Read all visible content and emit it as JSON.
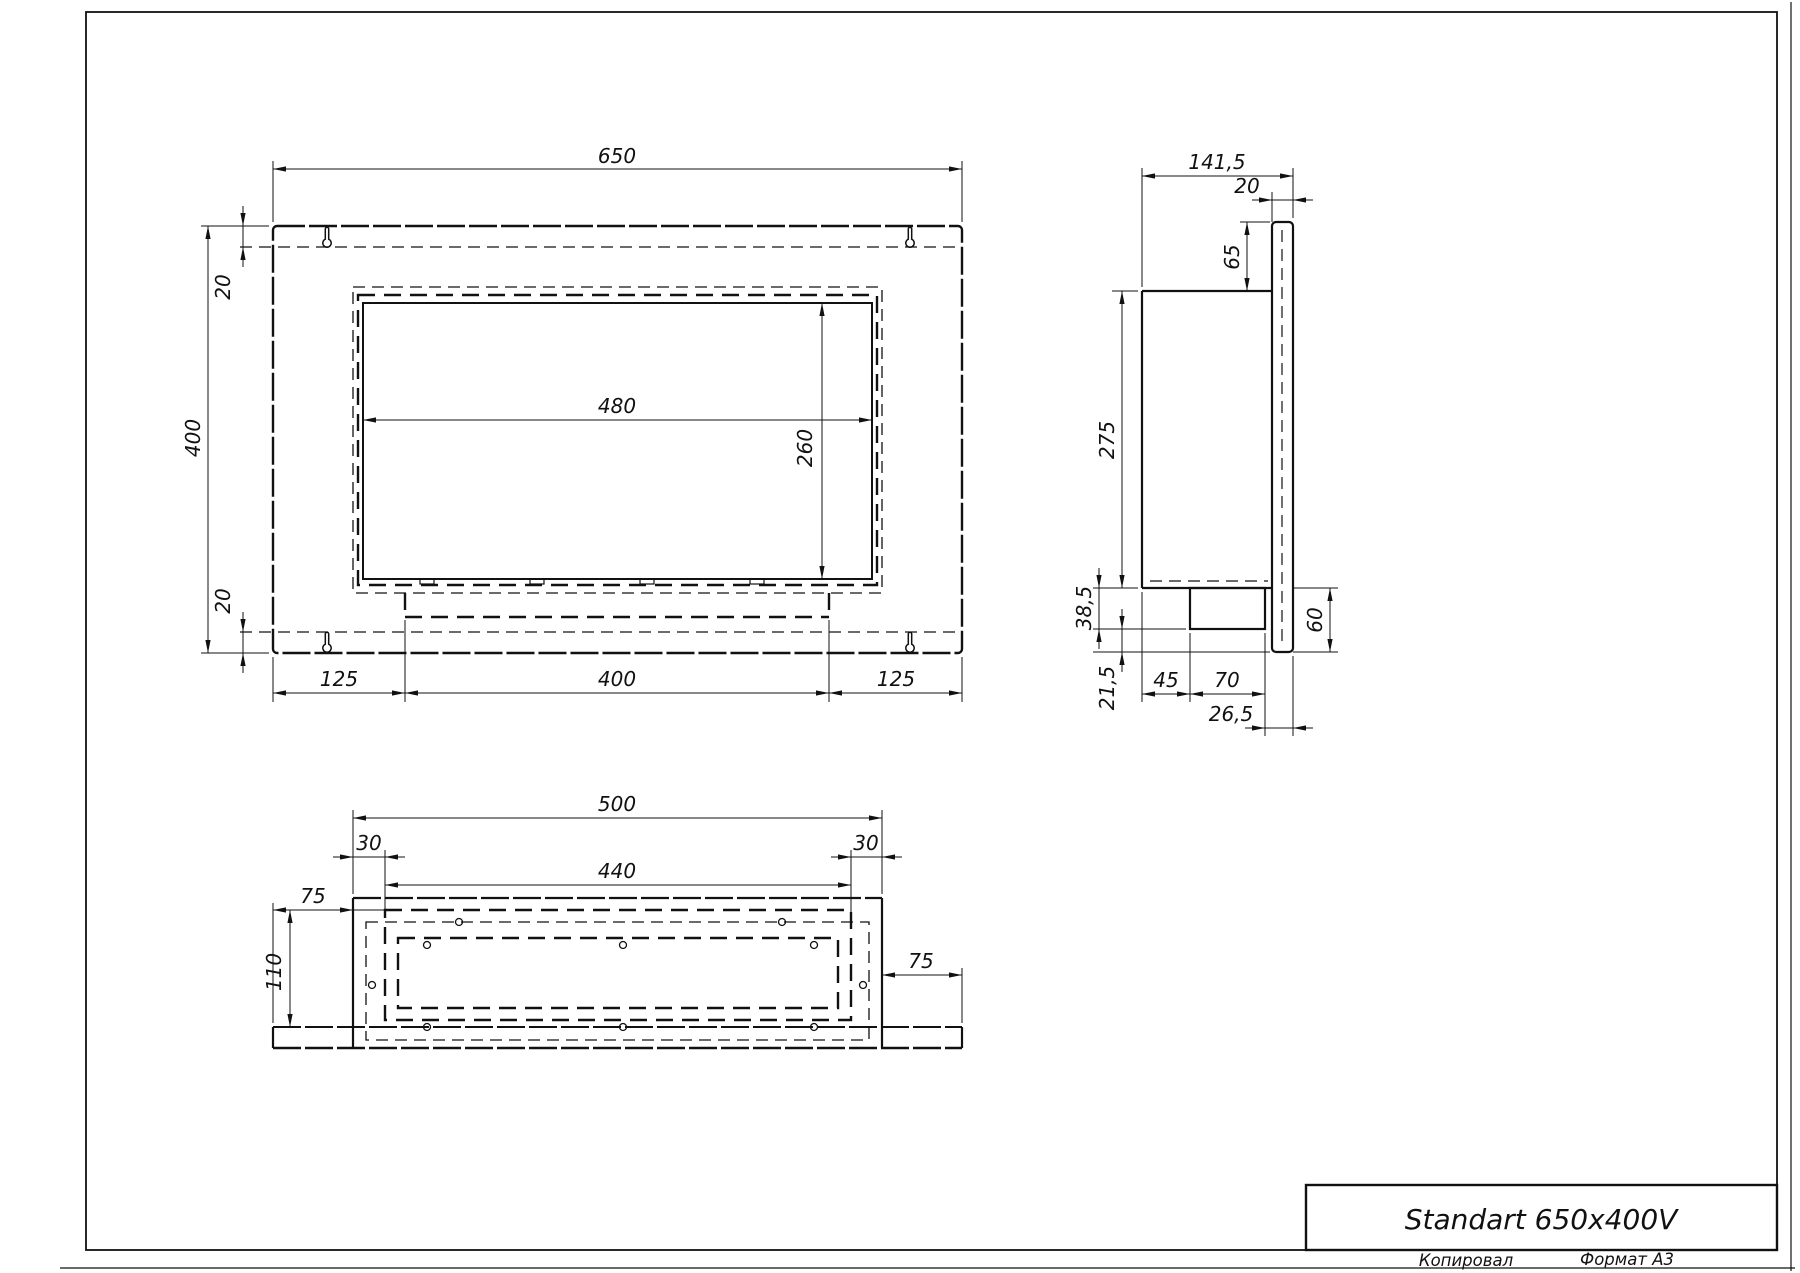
{
  "sheet": {
    "title": "Standart 650x400V",
    "footer_left": "Копировал",
    "footer_right": "Формат А3",
    "format": "A3"
  },
  "canvas": {
    "w": 1800,
    "h": 1273
  },
  "colors": {
    "line": "#111111",
    "background": "#ffffff"
  },
  "views": {
    "front_view_dimensions": [
      "650",
      "400",
      "20",
      "20",
      "480",
      "260",
      "125",
      "400",
      "125"
    ],
    "side_view_dimensions": [
      "141,5",
      "20",
      "65",
      "275",
      "38,5",
      "21,5",
      "45",
      "70",
      "26,5",
      "60"
    ],
    "bottom_view_dimensions": [
      "500",
      "30",
      "440",
      "30",
      "75",
      "110",
      "75"
    ]
  },
  "geometry": {
    "primitives": [
      {
        "k": "rect",
        "n": "sheet-frame",
        "x": 86,
        "y": 12,
        "w": 1691,
        "h": 1238,
        "lw": 1.8
      },
      {
        "k": "line",
        "n": "sheet-edge-right",
        "x1": 1791,
        "y1": 2,
        "x2": 1791,
        "y2": 1271,
        "lw": 1.2
      },
      {
        "k": "line",
        "n": "sheet-edge-bottom",
        "x1": 60,
        "y1": 1268,
        "x2": 1795,
        "y2": 1268,
        "lw": 1.2
      },
      {
        "k": "rect",
        "n": "title-block",
        "x": 1306,
        "y": 1185,
        "w": 471,
        "h": 65,
        "lw": 2.4
      },
      {
        "k": "text",
        "n": "title-block-title",
        "ref": "sheet.title",
        "x": 1541,
        "y": 1229,
        "fs": 28
      },
      {
        "k": "text",
        "n": "footer-copied-label",
        "ref": "sheet.footer_left",
        "x": 1466,
        "y": 1266,
        "fs": 16.5
      },
      {
        "k": "text",
        "n": "footer-format-label",
        "ref": "sheet.footer_right",
        "x": 1627,
        "y": 1265,
        "fs": 16.5
      },
      {
        "k": "rect",
        "n": "front-outer-panel",
        "x": 273,
        "y": 226,
        "w": 689,
        "h": 427,
        "lw": 2.4,
        "dash": "s",
        "rx": 4
      },
      {
        "k": "line",
        "n": "front-hidden-top-fold",
        "x1": 240,
        "y1": 247,
        "x2": 959,
        "y2": 247,
        "lw": 1.3,
        "dash": "t"
      },
      {
        "k": "line",
        "n": "front-hidden-bottom-fold",
        "x1": 240,
        "y1": 632,
        "x2": 959,
        "y2": 632,
        "lw": 1.3,
        "dash": "t"
      },
      {
        "k": "path",
        "n": "keyhole-slot-top-left",
        "d": "M 325.3 229 A 1.7 1.7 0 0 1 328.7 229 L 328.7 239.2 A 4.2 4.2 0 1 1 325.3 239.2 Z",
        "lw": 1.5
      },
      {
        "k": "path",
        "n": "keyhole-slot-top-right",
        "d": "M 908.3 229 A 1.7 1.7 0 0 1 911.7 229 L 911.7 239.2 A 4.2 4.2 0 1 1 908.3 239.2 Z",
        "lw": 1.5
      },
      {
        "k": "path",
        "n": "keyhole-slot-bottom-left",
        "d": "M 325.3 634 A 1.7 1.7 0 0 1 328.7 634 L 328.7 644.2 A 4.2 4.2 0 1 1 325.3 644.2 Z",
        "lw": 1.5
      },
      {
        "k": "path",
        "n": "keyhole-slot-bottom-right",
        "d": "M 908.3 634 A 1.7 1.7 0 0 1 911.7 634 L 911.7 644.2 A 4.2 4.2 0 1 1 908.3 644.2 Z",
        "lw": 1.5
      },
      {
        "k": "rect",
        "n": "front-hidden-box-outline",
        "x": 353,
        "y": 287,
        "w": 529,
        "h": 306,
        "lw": 1.3,
        "dash": "t"
      },
      {
        "k": "rect",
        "n": "front-hidden-frame-outline",
        "x": 358,
        "y": 295,
        "w": 519,
        "h": 290,
        "lw": 2.4,
        "dash": "h"
      },
      {
        "k": "rect",
        "n": "front-glass-opening",
        "x": 363,
        "y": 303,
        "w": 509,
        "h": 276,
        "lw": 2
      },
      {
        "k": "rect",
        "n": "glass-foot-tab",
        "x": 420,
        "y": 579,
        "w": 14,
        "h": 5,
        "lw": 1.2
      },
      {
        "k": "rect",
        "n": "glass-foot-tab",
        "x": 530,
        "y": 579,
        "w": 14,
        "h": 5,
        "lw": 1.2
      },
      {
        "k": "rect",
        "n": "glass-foot-tab",
        "x": 640,
        "y": 579,
        "w": 14,
        "h": 5,
        "lw": 1.2
      },
      {
        "k": "rect",
        "n": "glass-foot-tab",
        "x": 750,
        "y": 579,
        "w": 14,
        "h": 5,
        "lw": 1.2
      },
      {
        "k": "line",
        "n": "front-burner-hidden-bottom",
        "x1": 405,
        "y1": 617,
        "x2": 829,
        "y2": 617,
        "lw": 2.6,
        "dash": "h"
      },
      {
        "k": "line",
        "n": "front-burner-hidden-left",
        "x1": 405,
        "y1": 593,
        "x2": 405,
        "y2": 617,
        "lw": 2.4,
        "dash": "h"
      },
      {
        "k": "line",
        "n": "front-burner-hidden-right",
        "x1": 829,
        "y1": 593,
        "x2": 829,
        "y2": 617,
        "lw": 2.4,
        "dash": "h"
      },
      {
        "k": "line",
        "n": "ext-line",
        "x1": 273,
        "y1": 222,
        "x2": 273,
        "y2": 161,
        "lw": 1
      },
      {
        "k": "line",
        "n": "ext-line",
        "x1": 962,
        "y1": 222,
        "x2": 962,
        "y2": 161,
        "lw": 1
      },
      {
        "k": "line",
        "n": "ext-line",
        "x1": 269,
        "y1": 226,
        "x2": 201,
        "y2": 226,
        "lw": 1
      },
      {
        "k": "line",
        "n": "ext-line",
        "x1": 269,
        "y1": 653,
        "x2": 201,
        "y2": 653,
        "lw": 1
      },
      {
        "k": "line",
        "n": "ext-line",
        "x1": 273,
        "y1": 657,
        "x2": 273,
        "y2": 702,
        "lw": 1
      },
      {
        "k": "line",
        "n": "ext-line",
        "x1": 405,
        "y1": 620,
        "x2": 405,
        "y2": 702,
        "lw": 1
      },
      {
        "k": "line",
        "n": "ext-line",
        "x1": 829,
        "y1": 620,
        "x2": 829,
        "y2": 702,
        "lw": 1
      },
      {
        "k": "line",
        "n": "ext-line",
        "x1": 962,
        "y1": 657,
        "x2": 962,
        "y2": 702,
        "lw": 1
      },
      {
        "k": "dim",
        "n": "dim-650",
        "dir": "h",
        "a": 273,
        "b": 962,
        "c": 169,
        "l": "650",
        "tx": 617,
        "ty": 163
      },
      {
        "k": "dim",
        "n": "dim-400-height",
        "dir": "v",
        "a": 226,
        "b": 653,
        "c": 208,
        "l": "400",
        "tx": 200,
        "ty": 438,
        "rot": true
      },
      {
        "k": "dim",
        "n": "dim-20-top",
        "dir": "v",
        "a": 226,
        "b": 247,
        "c": 243,
        "l": "20",
        "tx": 230,
        "ty": 287,
        "rot": true,
        "out": true
      },
      {
        "k": "dim",
        "n": "dim-20-bottom",
        "dir": "v",
        "a": 632,
        "b": 653,
        "c": 243,
        "l": "20",
        "tx": 230,
        "ty": 601,
        "rot": true,
        "out": true
      },
      {
        "k": "dim",
        "n": "dim-480",
        "dir": "h",
        "a": 363,
        "b": 872,
        "c": 420,
        "l": "480",
        "tx": 617,
        "ty": 413
      },
      {
        "k": "dim",
        "n": "dim-260",
        "dir": "v",
        "a": 303,
        "b": 579,
        "c": 822,
        "l": "260",
        "tx": 812,
        "ty": 448,
        "rot": true
      },
      {
        "k": "dim",
        "n": "dim-125-left",
        "dir": "h",
        "a": 273,
        "b": 405,
        "c": 693,
        "l": "125",
        "tx": 339,
        "ty": 686
      },
      {
        "k": "dim",
        "n": "dim-400-burner",
        "dir": "h",
        "a": 405,
        "b": 829,
        "c": 693,
        "l": "400",
        "tx": 617,
        "ty": 686
      },
      {
        "k": "dim",
        "n": "dim-125-right",
        "dir": "h",
        "a": 829,
        "b": 962,
        "c": 693,
        "l": "125",
        "tx": 896,
        "ty": 686
      },
      {
        "k": "line",
        "n": "side-box-top",
        "x1": 1142,
        "y1": 291,
        "x2": 1272,
        "y2": 291,
        "lw": 2.2
      },
      {
        "k": "line",
        "n": "side-box-left",
        "x1": 1142,
        "y1": 291,
        "x2": 1142,
        "y2": 588,
        "lw": 2.2
      },
      {
        "k": "line",
        "n": "side-box-bottom",
        "x1": 1142,
        "y1": 588,
        "x2": 1272,
        "y2": 588,
        "lw": 2.2
      },
      {
        "k": "rect",
        "n": "side-wall-plate",
        "x": 1272,
        "y": 222,
        "w": 21,
        "h": 430,
        "lw": 2.2,
        "rx": 4
      },
      {
        "k": "line",
        "n": "side-plate-hidden-line",
        "x1": 1282,
        "y1": 230,
        "x2": 1282,
        "y2": 645,
        "lw": 1.2,
        "dash": "t"
      },
      {
        "k": "line",
        "n": "side-hidden-burner-top",
        "x1": 1150,
        "y1": 581,
        "x2": 1268,
        "y2": 581,
        "lw": 1.3,
        "dash": "t"
      },
      {
        "k": "rect",
        "n": "side-burner-protrusion",
        "x": 1190,
        "y": 588,
        "w": 75,
        "h": 41,
        "lw": 2.2
      },
      {
        "k": "line",
        "n": "ext-line",
        "x1": 1142,
        "y1": 287,
        "x2": 1142,
        "y2": 168,
        "lw": 1
      },
      {
        "k": "line",
        "n": "ext-line",
        "x1": 1293,
        "y1": 218,
        "x2": 1293,
        "y2": 168,
        "lw": 1
      },
      {
        "k": "line",
        "n": "ext-line",
        "x1": 1272,
        "y1": 222,
        "x2": 1272,
        "y2": 192,
        "lw": 1
      },
      {
        "k": "line",
        "n": "ext-line",
        "x1": 1240,
        "y1": 222,
        "x2": 1270,
        "y2": 222,
        "lw": 1
      },
      {
        "k": "line",
        "n": "ext-line",
        "x1": 1138,
        "y1": 291,
        "x2": 1112,
        "y2": 291,
        "lw": 1
      },
      {
        "k": "line",
        "n": "ext-line",
        "x1": 1138,
        "y1": 588,
        "x2": 1093,
        "y2": 588,
        "lw": 1
      },
      {
        "k": "line",
        "n": "ext-line",
        "x1": 1293,
        "y1": 588,
        "x2": 1338,
        "y2": 588,
        "lw": 1
      },
      {
        "k": "line",
        "n": "ext-line",
        "x1": 1186,
        "y1": 629,
        "x2": 1093,
        "y2": 629,
        "lw": 1
      },
      {
        "k": "line",
        "n": "ext-line",
        "x1": 1093,
        "y1": 652,
        "x2": 1270,
        "y2": 652,
        "lw": 1
      },
      {
        "k": "line",
        "n": "ext-line",
        "x1": 1293,
        "y1": 652,
        "x2": 1338,
        "y2": 652,
        "lw": 1
      },
      {
        "k": "line",
        "n": "ext-line",
        "x1": 1142,
        "y1": 592,
        "x2": 1142,
        "y2": 702,
        "lw": 1
      },
      {
        "k": "line",
        "n": "ext-line",
        "x1": 1190,
        "y1": 633,
        "x2": 1190,
        "y2": 702,
        "lw": 1
      },
      {
        "k": "line",
        "n": "ext-line",
        "x1": 1265,
        "y1": 633,
        "x2": 1265,
        "y2": 736,
        "lw": 1
      },
      {
        "k": "line",
        "n": "ext-line",
        "x1": 1293,
        "y1": 656,
        "x2": 1293,
        "y2": 736,
        "lw": 1
      },
      {
        "k": "dim",
        "n": "dim-141-5",
        "dir": "h",
        "a": 1142,
        "b": 1293,
        "c": 176,
        "l": "141,5",
        "tx": 1217,
        "ty": 169
      },
      {
        "k": "dim",
        "n": "dim-20-plate",
        "dir": "h",
        "a": 1272,
        "b": 1293,
        "c": 200,
        "l": "20",
        "tx": 1247,
        "ty": 193,
        "out": true
      },
      {
        "k": "dim",
        "n": "dim-65",
        "dir": "v",
        "a": 222,
        "b": 291,
        "c": 1247,
        "l": "65",
        "tx": 1239,
        "ty": 257,
        "rot": true
      },
      {
        "k": "dim",
        "n": "dim-275",
        "dir": "v",
        "a": 291,
        "b": 588,
        "c": 1122,
        "l": "275",
        "tx": 1114,
        "ty": 440,
        "rot": true
      },
      {
        "k": "dim",
        "n": "dim-38-5",
        "dir": "v",
        "a": 588,
        "b": 629,
        "c": 1099,
        "l": "38,5",
        "tx": 1091,
        "ty": 608,
        "rot": true,
        "out": true
      },
      {
        "k": "dim",
        "n": "dim-21-5",
        "dir": "v",
        "a": 629,
        "b": 652,
        "c": 1122,
        "l": "21,5",
        "tx": 1114,
        "ty": 688,
        "rot": true,
        "out": true
      },
      {
        "k": "dim",
        "n": "dim-60",
        "dir": "v",
        "a": 588,
        "b": 652,
        "c": 1330,
        "l": "60",
        "tx": 1322,
        "ty": 620,
        "rot": true
      },
      {
        "k": "dim",
        "n": "dim-45",
        "dir": "h",
        "a": 1142,
        "b": 1190,
        "c": 694,
        "l": "45",
        "tx": 1166,
        "ty": 687
      },
      {
        "k": "dim",
        "n": "dim-70",
        "dir": "h",
        "a": 1190,
        "b": 1265,
        "c": 694,
        "l": "70",
        "tx": 1227,
        "ty": 687
      },
      {
        "k": "dim",
        "n": "dim-26-5",
        "dir": "h",
        "a": 1265,
        "b": 1293,
        "c": 728,
        "l": "26,5",
        "tx": 1231,
        "ty": 721,
        "out": true
      },
      {
        "k": "line",
        "n": "bottom-box-left",
        "x1": 353,
        "y1": 898,
        "x2": 353,
        "y2": 1048,
        "lw": 2.2
      },
      {
        "k": "line",
        "n": "bottom-box-right",
        "x1": 882,
        "y1": 898,
        "x2": 882,
        "y2": 1048,
        "lw": 2.2
      },
      {
        "k": "line",
        "n": "bottom-box-front",
        "x1": 353,
        "y1": 898,
        "x2": 882,
        "y2": 898,
        "lw": 2.2,
        "dash": "s"
      },
      {
        "k": "line",
        "n": "bottom-plate-inner-edge",
        "x1": 273,
        "y1": 1027,
        "x2": 962,
        "y2": 1027,
        "lw": 2,
        "dash": "s"
      },
      {
        "k": "line",
        "n": "bottom-plate-left",
        "x1": 273,
        "y1": 1027,
        "x2": 273,
        "y2": 1048,
        "lw": 2.2
      },
      {
        "k": "line",
        "n": "bottom-plate-right",
        "x1": 962,
        "y1": 1027,
        "x2": 962,
        "y2": 1048,
        "lw": 2.2
      },
      {
        "k": "line",
        "n": "bottom-plate-bottom",
        "x1": 273,
        "y1": 1048,
        "x2": 962,
        "y2": 1048,
        "lw": 2.4,
        "dash": "s"
      },
      {
        "k": "rect",
        "n": "bottom-hidden-inner-wall",
        "x": 366,
        "y": 922,
        "w": 503,
        "h": 118,
        "lw": 1.3,
        "dash": "t"
      },
      {
        "k": "rect",
        "n": "bottom-burner-outer",
        "x": 385,
        "y": 910,
        "w": 466,
        "h": 110,
        "lw": 2.4,
        "dash": "h"
      },
      {
        "k": "rect",
        "n": "bottom-burner-inner",
        "x": 398,
        "y": 938,
        "w": 440,
        "h": 70,
        "lw": 2.4,
        "dash": "h"
      },
      {
        "k": "circle",
        "n": "screw-hole",
        "cx": 459,
        "cy": 922,
        "r": 3.5
      },
      {
        "k": "circle",
        "n": "screw-hole",
        "cx": 782,
        "cy": 922,
        "r": 3.5
      },
      {
        "k": "circle",
        "n": "screw-hole",
        "cx": 427,
        "cy": 945,
        "r": 3.5
      },
      {
        "k": "circle",
        "n": "screw-hole",
        "cx": 623,
        "cy": 945,
        "r": 3.5
      },
      {
        "k": "circle",
        "n": "screw-hole",
        "cx": 814,
        "cy": 945,
        "r": 3.5
      },
      {
        "k": "circle",
        "n": "screw-hole",
        "cx": 372,
        "cy": 985,
        "r": 3.5
      },
      {
        "k": "circle",
        "n": "screw-hole",
        "cx": 863,
        "cy": 985,
        "r": 3.5
      },
      {
        "k": "circle",
        "n": "screw-hole",
        "cx": 427,
        "cy": 1027,
        "r": 3.5
      },
      {
        "k": "circle",
        "n": "screw-hole",
        "cx": 623,
        "cy": 1027,
        "r": 3.5
      },
      {
        "k": "circle",
        "n": "screw-hole",
        "cx": 814,
        "cy": 1027,
        "r": 3.5
      },
      {
        "k": "line",
        "n": "ext-line",
        "x1": 353,
        "y1": 894,
        "x2": 353,
        "y2": 810,
        "lw": 1
      },
      {
        "k": "line",
        "n": "ext-line",
        "x1": 882,
        "y1": 894,
        "x2": 882,
        "y2": 810,
        "lw": 1
      },
      {
        "k": "line",
        "n": "ext-line",
        "x1": 385,
        "y1": 850,
        "x2": 385,
        "y2": 914,
        "lw": 1
      },
      {
        "k": "line",
        "n": "ext-line",
        "x1": 851,
        "y1": 850,
        "x2": 851,
        "y2": 914,
        "lw": 1
      },
      {
        "k": "line",
        "n": "ext-line",
        "x1": 273,
        "y1": 903,
        "x2": 273,
        "y2": 1023,
        "lw": 1
      },
      {
        "k": "line",
        "n": "ext-line",
        "x1": 962,
        "y1": 968,
        "x2": 962,
        "y2": 1023,
        "lw": 1
      },
      {
        "k": "line",
        "n": "ext-line",
        "x1": 283,
        "y1": 910,
        "x2": 389,
        "y2": 910,
        "lw": 1
      },
      {
        "k": "dim",
        "n": "dim-500",
        "dir": "h",
        "a": 353,
        "b": 882,
        "c": 818,
        "l": "500",
        "tx": 617,
        "ty": 811
      },
      {
        "k": "dim",
        "n": "dim-30-left",
        "dir": "h",
        "a": 353,
        "b": 385,
        "c": 857,
        "l": "30",
        "tx": 369,
        "ty": 850,
        "out": true
      },
      {
        "k": "dim",
        "n": "dim-30-right",
        "dir": "h",
        "a": 851,
        "b": 882,
        "c": 857,
        "l": "30",
        "tx": 866,
        "ty": 850,
        "out": true
      },
      {
        "k": "dim",
        "n": "dim-440",
        "dir": "h",
        "a": 385,
        "b": 851,
        "c": 885,
        "l": "440",
        "tx": 617,
        "ty": 878
      },
      {
        "k": "dim",
        "n": "dim-75-left",
        "dir": "h",
        "a": 273,
        "b": 353,
        "c": 910,
        "l": "75",
        "tx": 313,
        "ty": 903
      },
      {
        "k": "dim",
        "n": "dim-75-right",
        "dir": "h",
        "a": 882,
        "b": 962,
        "c": 975,
        "l": "75",
        "tx": 921,
        "ty": 968
      },
      {
        "k": "dim",
        "n": "dim-110",
        "dir": "v",
        "a": 910,
        "b": 1027,
        "c": 290,
        "l": "110",
        "tx": 281,
        "ty": 972,
        "rot": true
      }
    ]
  }
}
